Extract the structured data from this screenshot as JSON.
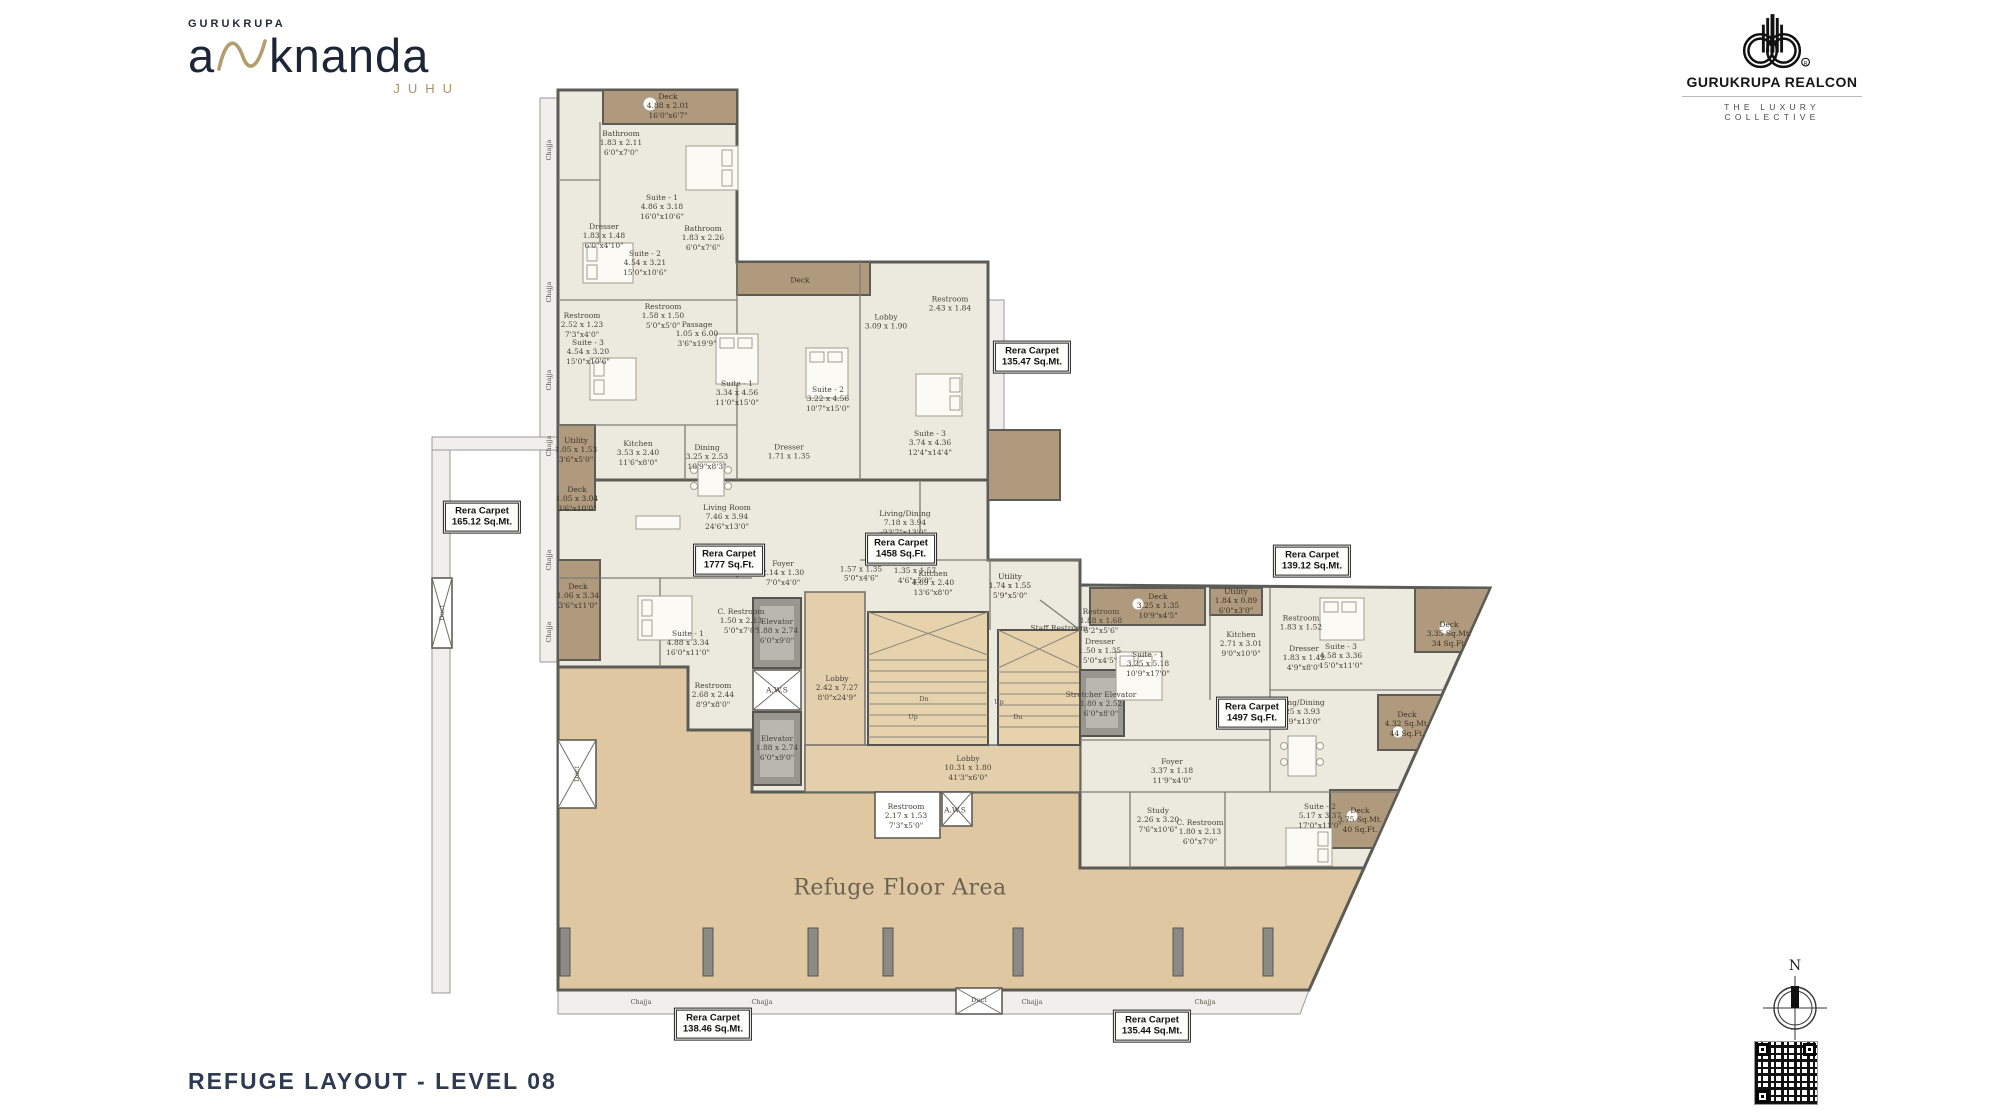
{
  "brand": {
    "top_left": {
      "company": "GURUKRUPA",
      "word_a": "a",
      "word_rest": "knanda",
      "city": "JUHU"
    },
    "top_right": {
      "name": "GURUKRUPA REALCON",
      "reg": "®",
      "tagline": "THE LUXURY COLLECTIVE"
    }
  },
  "title": "REFUGE LAYOUT - LEVEL 08",
  "compass": {
    "north": "N"
  },
  "colors": {
    "refuge_fill": "#dfc7a1",
    "deck_fill": "#b09a7d",
    "room_fill": "#eceadf",
    "wall": "#5c5b55",
    "title_navy": "#2d3a52",
    "gold": "#ab946a"
  },
  "plan": {
    "refuge_label": "Refuge Floor Area",
    "rera_label": "Rera Carpet",
    "rera_boxes": [
      {
        "value": "165.12 Sq.Mt.",
        "x": 482,
        "y": 517
      },
      {
        "value": "135.47 Sq.Mt.",
        "x": 1032,
        "y": 357
      },
      {
        "value": "1777 Sq.Ft.",
        "x": 729,
        "y": 560
      },
      {
        "value": "1458 Sq.Ft.",
        "x": 901,
        "y": 549
      },
      {
        "value": "139.12 Sq.Mt.",
        "x": 1312,
        "y": 561
      },
      {
        "value": "1497 Sq.Ft.",
        "x": 1252,
        "y": 713
      },
      {
        "value": "138.46 Sq.Mt.",
        "x": 713,
        "y": 1024
      },
      {
        "value": "135.44 Sq.Mt.",
        "x": 1152,
        "y": 1026
      }
    ],
    "rooms": [
      {
        "name": "Deck",
        "m": "4.88 x 2.01",
        "ft": "16'0\"x6'7\"",
        "x": 668,
        "y": 106,
        "deck": true
      },
      {
        "name": "Bathroom",
        "m": "1.83 x 2.11",
        "ft": "6'0\"x7'0\"",
        "x": 621,
        "y": 143
      },
      {
        "name": "Suite - 1",
        "m": "4.86 x 3.18",
        "ft": "16'0\"x10'6\"",
        "x": 662,
        "y": 207
      },
      {
        "name": "Dresser",
        "m": "1.83 x 1.48",
        "ft": "6'0\"x4'10\"",
        "x": 604,
        "y": 236
      },
      {
        "name": "Bathroom",
        "m": "1.83 x 2.26",
        "ft": "6'0\"x7'6\"",
        "x": 703,
        "y": 238
      },
      {
        "name": "Suite - 2",
        "m": "4.54 x 3.21",
        "ft": "15'0\"x10'6\"",
        "x": 645,
        "y": 263
      },
      {
        "name": "Restroom",
        "m": "2.52 x 1.23",
        "ft": "7'3\"x4'0\"",
        "x": 582,
        "y": 325
      },
      {
        "name": "Restroom",
        "m": "1.58 x 1.50",
        "ft": "5'0\"x5'0\"",
        "x": 663,
        "y": 316
      },
      {
        "name": "Suite - 3",
        "m": "4.54 x 3.20",
        "ft": "15'0\"x10'6\"",
        "x": 588,
        "y": 352
      },
      {
        "name": "Passage",
        "m": "1.05 x 6.00",
        "ft": "3'6\"x19'9\"",
        "x": 697,
        "y": 334
      },
      {
        "name": "Deck",
        "m": "",
        "ft": "",
        "x": 800,
        "y": 280,
        "deck": true
      },
      {
        "name": "Suite - 1",
        "m": "3.34 x 4.56",
        "ft": "11'0\"x15'0\"",
        "x": 737,
        "y": 393
      },
      {
        "name": "Suite - 2",
        "m": "3.22 x 4.56",
        "ft": "10'7\"x15'0\"",
        "x": 828,
        "y": 399
      },
      {
        "name": "Suite - 3",
        "m": "3.74 x 4.36",
        "ft": "12'4\"x14'4\"",
        "x": 930,
        "y": 443
      },
      {
        "name": "Lobby",
        "m": "3.09 x 1.90",
        "ft": "",
        "x": 886,
        "y": 322
      },
      {
        "name": "Restroom",
        "m": "2.43 x 1.84",
        "ft": "",
        "x": 950,
        "y": 304
      },
      {
        "name": "Kitchen",
        "m": "3.53 x 2.40",
        "ft": "11'6\"x8'0\"",
        "x": 638,
        "y": 453
      },
      {
        "name": "Dining",
        "m": "3.25 x 2.53",
        "ft": "10'9\"x8'3\"",
        "x": 707,
        "y": 457
      },
      {
        "name": "Utility",
        "m": "1.05 x 1.53",
        "ft": "3'6\"x5'0\"",
        "x": 576,
        "y": 450,
        "deck": true
      },
      {
        "name": "Deck",
        "m": "1.05 x 3.04",
        "ft": "3'6\"x10'0\"",
        "x": 577,
        "y": 499,
        "deck": true
      },
      {
        "name": "Dresser",
        "m": "1.71 x 1.35",
        "ft": "",
        "x": 789,
        "y": 452
      },
      {
        "name": "Living Room",
        "m": "7.46 x 3.94",
        "ft": "24'6\"x13'0\"",
        "x": 727,
        "y": 517
      },
      {
        "name": "Living/Dining",
        "m": "7.18 x 3.94",
        "ft": "23'7\"x13'0\"",
        "x": 905,
        "y": 523
      },
      {
        "name": "Kitchen",
        "m": "4.09 x 2.40",
        "ft": "13'6\"x8'0\"",
        "x": 933,
        "y": 583
      },
      {
        "name": "Utility",
        "m": "1.74 x 1.55",
        "ft": "5'9\"x5'0\"",
        "x": 1010,
        "y": 586,
        "deck": true
      },
      {
        "name": "Foyer",
        "m": "2.14 x 1.30",
        "ft": "7'0\"x4'0\"",
        "x": 783,
        "y": 573
      },
      {
        "name": "",
        "m": "1.57 x 1.35",
        "ft": "5'0\"x4'6\"",
        "x": 861,
        "y": 574
      },
      {
        "name": "Foyer",
        "m": "1.35 x 1.57",
        "ft": "4'6\"x5'0\"",
        "x": 915,
        "y": 571
      },
      {
        "name": "Deck",
        "m": "1.06 x 3.34",
        "ft": "3'6\"x11'0\"",
        "x": 578,
        "y": 596,
        "deck": true
      },
      {
        "name": "Suite - 1",
        "m": "4.88 x 3.34",
        "ft": "16'0\"x11'0\"",
        "x": 688,
        "y": 643
      },
      {
        "name": "C. Restroom",
        "m": "1.50 x 2.13",
        "ft": "5'0\"x7'0\"",
        "x": 741,
        "y": 621
      },
      {
        "name": "Restroom",
        "m": "2.68 x 2.44",
        "ft": "8'9\"x8'0\"",
        "x": 713,
        "y": 695
      },
      {
        "name": "Elevator",
        "m": "1.88 x 2.74",
        "ft": "6'0\"x9'0\"",
        "x": 777,
        "y": 631
      },
      {
        "name": "A.W.S",
        "m": "",
        "ft": "",
        "x": 777,
        "y": 690
      },
      {
        "name": "Elevator",
        "m": "1.88 x 2.74",
        "ft": "6'0\"x9'0\"",
        "x": 777,
        "y": 748
      },
      {
        "name": "Lobby",
        "m": "2.42 x 7.27",
        "ft": "8'0\"x24'9\"",
        "x": 837,
        "y": 688
      },
      {
        "name": "Staff Restroom",
        "m": "",
        "ft": "",
        "x": 1059,
        "y": 628
      },
      {
        "name": "Lobby",
        "m": "10.31 x 1.80",
        "ft": "41'3\"x6'0\"",
        "x": 968,
        "y": 768
      },
      {
        "name": "Restroom",
        "m": "2.17 x 1.53",
        "ft": "7'3\"x5'0\"",
        "x": 906,
        "y": 816
      },
      {
        "name": "A.W.S",
        "m": "",
        "ft": "",
        "x": 955,
        "y": 810
      },
      {
        "name": "Deck",
        "m": "3.25 x 1.35",
        "ft": "10'9\"x4'5\"",
        "x": 1158,
        "y": 606,
        "deck": true
      },
      {
        "name": "Utility",
        "m": "1.84 x 0.89",
        "ft": "6'0\"x3'0\"",
        "x": 1236,
        "y": 601,
        "deck": true
      },
      {
        "name": "Restroom",
        "m": "1.88 x 1.68",
        "ft": "6'2\"x5'6\"",
        "x": 1101,
        "y": 621
      },
      {
        "name": "Dresser",
        "m": "1.50 x 1.35",
        "ft": "5'0\"x4'5\"",
        "x": 1100,
        "y": 651
      },
      {
        "name": "Suite - 1",
        "m": "3.25 x 5.18",
        "ft": "10'9\"x17'0\"",
        "x": 1148,
        "y": 664
      },
      {
        "name": "Kitchen",
        "m": "2.71 x 3.01",
        "ft": "9'0\"x10'0\"",
        "x": 1241,
        "y": 644
      },
      {
        "name": "Stretcher Elevator",
        "m": "1.80 x 2.52",
        "ft": "6'0\"x8'0\"",
        "x": 1101,
        "y": 704
      },
      {
        "name": "Restroom",
        "m": "1.83 x 1.52",
        "ft": "",
        "x": 1301,
        "y": 623
      },
      {
        "name": "Dresser",
        "m": "1.83 x 1.42",
        "ft": "4'9\"x8'0\"",
        "x": 1304,
        "y": 658
      },
      {
        "name": "Living/Dining",
        "m": "7.25 x 3.93",
        "ft": "23'9\"x13'0\"",
        "x": 1299,
        "y": 712
      },
      {
        "name": "Suite - 3",
        "m": "4.58 x 3.36",
        "ft": "15'0\"x11'0\"",
        "x": 1341,
        "y": 656
      },
      {
        "name": "Deck",
        "m": "3.35 Sq.Mt.",
        "ft": "34 Sq.Ft.",
        "x": 1449,
        "y": 634,
        "deck": true
      },
      {
        "name": "Deck",
        "m": "4.32 Sq.Mt.",
        "ft": "44 Sq.Ft.",
        "x": 1407,
        "y": 724,
        "deck": true
      },
      {
        "name": "Deck",
        "m": "3.75 Sq.Mt.",
        "ft": "40 Sq.Ft.",
        "x": 1360,
        "y": 820,
        "deck": true
      },
      {
        "name": "Foyer",
        "m": "3.37 x 1.18",
        "ft": "11'9\"x4'0\"",
        "x": 1172,
        "y": 771
      },
      {
        "name": "Study",
        "m": "2.26 x 3.20",
        "ft": "7'6\"x10'6\"",
        "x": 1158,
        "y": 820
      },
      {
        "name": "C. Restroom",
        "m": "1.80 x 2.13",
        "ft": "6'0\"x7'0\"",
        "x": 1200,
        "y": 832
      },
      {
        "name": "Suite - 2",
        "m": "5.17 x 3.37",
        "ft": "17'0\"x11'0\"",
        "x": 1320,
        "y": 816
      }
    ],
    "small_labels": [
      {
        "text": "Chajja",
        "x": 549,
        "y": 150,
        "rot": -90
      },
      {
        "text": "Chajja",
        "x": 549,
        "y": 292,
        "rot": -90
      },
      {
        "text": "Chajja",
        "x": 549,
        "y": 380,
        "rot": -90
      },
      {
        "text": "Chajja",
        "x": 549,
        "y": 446,
        "rot": -90
      },
      {
        "text": "Chajja",
        "x": 549,
        "y": 560,
        "rot": -90
      },
      {
        "text": "Chajja",
        "x": 549,
        "y": 632,
        "rot": -90
      },
      {
        "text": "Duct",
        "x": 577,
        "y": 774,
        "rot": -90
      },
      {
        "text": "Duct",
        "x": 442,
        "y": 613,
        "rot": -90
      },
      {
        "text": "Chajja",
        "x": 641,
        "y": 1002
      },
      {
        "text": "Chajja",
        "x": 762,
        "y": 1002
      },
      {
        "text": "Chajja",
        "x": 1032,
        "y": 1002
      },
      {
        "text": "Chajja",
        "x": 1205,
        "y": 1002
      },
      {
        "text": "Duct",
        "x": 979,
        "y": 1000
      },
      {
        "text": "Dn",
        "x": 924,
        "y": 699
      },
      {
        "text": "Up",
        "x": 913,
        "y": 717
      },
      {
        "text": "Up",
        "x": 999,
        "y": 702
      },
      {
        "text": "Dn",
        "x": 1018,
        "y": 717
      }
    ]
  }
}
